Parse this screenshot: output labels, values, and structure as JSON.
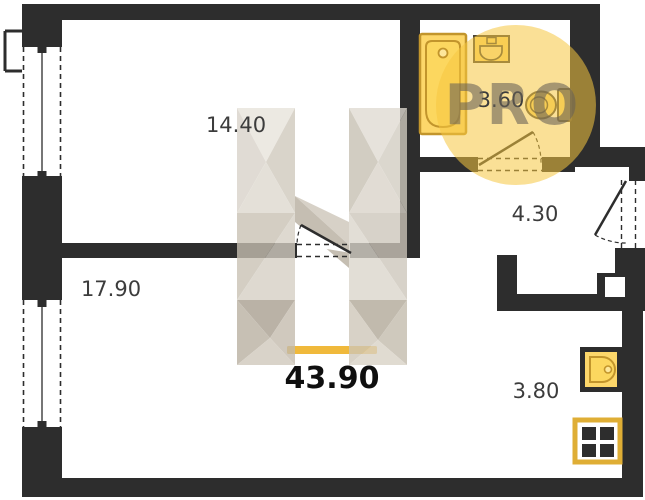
{
  "title": "Apartment floor plan",
  "total": {
    "label": "43.90"
  },
  "watermark": {
    "text": "PRO"
  },
  "rooms": [
    {
      "name": "room-top",
      "area": "14.40"
    },
    {
      "name": "bathroom",
      "area": "3.60"
    },
    {
      "name": "hallway",
      "area": "4.30"
    },
    {
      "name": "room-bottom",
      "area": "17.90"
    },
    {
      "name": "kitchen",
      "area": "3.80"
    }
  ],
  "colors": {
    "wall": "#2d2d2d",
    "fixture_fill": "#fdd76a",
    "fixture_stroke": "#c2952c",
    "accent_bar": "#f0b93b",
    "watermark_circle": "#f6c63f",
    "watermark_text": "#696257",
    "label_text": "#3c3c3c",
    "total_text": "#0f0f0f"
  }
}
